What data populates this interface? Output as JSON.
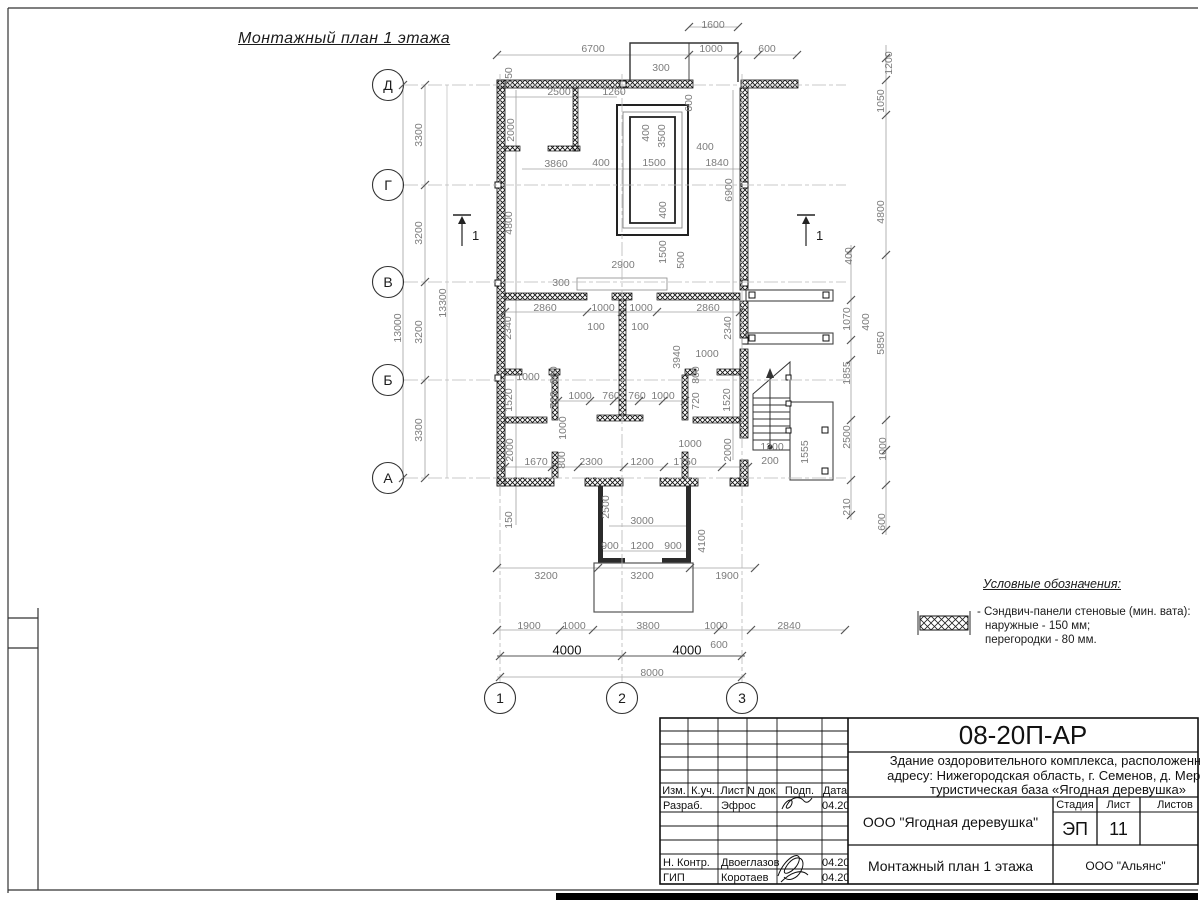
{
  "drawing_title": "Монтажный план 1 этажа",
  "colors": {
    "wall": "#111111",
    "dim_text": "#7c7c7c",
    "dim_line": "#a0a0a0",
    "axis_line": "#b8b8b8",
    "dark_text": "#111111"
  },
  "axes": {
    "rows": [
      {
        "label": "Д",
        "y": 85
      },
      {
        "label": "Г",
        "y": 185
      },
      {
        "label": "В",
        "y": 282
      },
      {
        "label": "Б",
        "y": 380
      },
      {
        "label": "А",
        "y": 478
      }
    ],
    "cols": [
      {
        "label": "1",
        "x": 500
      },
      {
        "label": "2",
        "x": 622
      },
      {
        "label": "3",
        "x": 742
      }
    ]
  },
  "section_marks": [
    {
      "label": "1",
      "x": 462,
      "y": 228
    },
    {
      "label": "1",
      "x": 806,
      "y": 228
    }
  ],
  "dimensions": [
    [
      "1600",
      713,
      25,
      0
    ],
    [
      "6700",
      593,
      49,
      0
    ],
    [
      "1000",
      711,
      49,
      0
    ],
    [
      "600",
      767,
      49,
      0
    ],
    [
      "300",
      661,
      68,
      0
    ],
    [
      "150",
      509,
      76,
      1
    ],
    [
      "2500",
      559,
      92,
      0
    ],
    [
      "1260",
      614,
      92,
      0
    ],
    [
      "600",
      689,
      103,
      1
    ],
    [
      "2000",
      511,
      130,
      1
    ],
    [
      "400",
      646,
      133,
      1
    ],
    [
      "3500",
      662,
      136,
      1
    ],
    [
      "3860",
      556,
      164,
      0
    ],
    [
      "400",
      601,
      163,
      0
    ],
    [
      "1500",
      654,
      163,
      0
    ],
    [
      "400",
      705,
      147,
      0
    ],
    [
      "1840",
      717,
      163,
      0
    ],
    [
      "6900",
      729,
      190,
      1
    ],
    [
      "4800",
      509,
      223,
      1
    ],
    [
      "400",
      663,
      210,
      1
    ],
    [
      "1500",
      663,
      252,
      1
    ],
    [
      "500",
      681,
      260,
      1
    ],
    [
      "2900",
      623,
      265,
      0
    ],
    [
      "300",
      561,
      283,
      0
    ],
    [
      "2860",
      545,
      308,
      0
    ],
    [
      "1000",
      603,
      308,
      0
    ],
    [
      "1000",
      641,
      308,
      0
    ],
    [
      "2860",
      708,
      308,
      0
    ],
    [
      "100",
      596,
      327,
      0
    ],
    [
      "100",
      640,
      327,
      0
    ],
    [
      "2340",
      508,
      328,
      1
    ],
    [
      "2340",
      728,
      328,
      1
    ],
    [
      "1000",
      528,
      377,
      0
    ],
    [
      "3940",
      677,
      357,
      1
    ],
    [
      "1000",
      707,
      354,
      0
    ],
    [
      "800",
      554,
      375,
      1
    ],
    [
      "720",
      554,
      400,
      1
    ],
    [
      "1520",
      509,
      400,
      1
    ],
    [
      "800",
      696,
      375,
      1
    ],
    [
      "720",
      696,
      401,
      1
    ],
    [
      "1520",
      727,
      400,
      1
    ],
    [
      "1000",
      580,
      396,
      0
    ],
    [
      "760",
      611,
      396,
      0
    ],
    [
      "760",
      637,
      396,
      0
    ],
    [
      "1000",
      663,
      396,
      0
    ],
    [
      "1000",
      563,
      428,
      1
    ],
    [
      "1000",
      690,
      444,
      0
    ],
    [
      "2000",
      510,
      450,
      1
    ],
    [
      "2000",
      728,
      450,
      1
    ],
    [
      "800",
      562,
      460,
      1
    ],
    [
      "1670",
      536,
      462,
      0
    ],
    [
      "2300",
      591,
      462,
      0
    ],
    [
      "1200",
      642,
      462,
      0
    ],
    [
      "1750",
      685,
      462,
      0
    ],
    [
      "1200",
      772,
      447,
      0
    ],
    [
      "200",
      770,
      461,
      0
    ],
    [
      "1555",
      805,
      452,
      1
    ],
    [
      "150",
      509,
      520,
      1
    ],
    [
      "2500",
      606,
      507,
      1
    ],
    [
      "3000",
      642,
      521,
      0
    ],
    [
      "900",
      610,
      546,
      0
    ],
    [
      "1200",
      642,
      546,
      0
    ],
    [
      "900",
      673,
      546,
      0
    ],
    [
      "4100",
      702,
      541,
      1
    ],
    [
      "3200",
      546,
      576,
      0
    ],
    [
      "3200",
      642,
      576,
      0
    ],
    [
      "1900",
      727,
      576,
      0
    ],
    [
      "1900",
      529,
      626,
      0
    ],
    [
      "1000",
      574,
      626,
      0
    ],
    [
      "3800",
      648,
      626,
      0
    ],
    [
      "1000",
      716,
      626,
      0
    ],
    [
      "2840",
      789,
      626,
      0
    ],
    [
      "4000",
      567,
      650,
      2
    ],
    [
      "4000",
      687,
      650,
      2
    ],
    [
      "600",
      719,
      645,
      0
    ],
    [
      "8000",
      652,
      673,
      0
    ],
    [
      "3300",
      419,
      135,
      1
    ],
    [
      "3200",
      419,
      233,
      1
    ],
    [
      "3200",
      419,
      332,
      1
    ],
    [
      "3300",
      419,
      430,
      1
    ],
    [
      "13000",
      398,
      328,
      1
    ],
    [
      "13300",
      443,
      303,
      1
    ],
    [
      "1200",
      889,
      63,
      1
    ],
    [
      "1050",
      881,
      101,
      1
    ],
    [
      "4800",
      881,
      212,
      1
    ],
    [
      "400",
      849,
      256,
      1
    ],
    [
      "1070",
      847,
      319,
      1
    ],
    [
      "400",
      866,
      322,
      1
    ],
    [
      "5850",
      881,
      343,
      1
    ],
    [
      "1855",
      847,
      373,
      1
    ],
    [
      "2500",
      847,
      437,
      1
    ],
    [
      "1000",
      883,
      449,
      1
    ],
    [
      "210",
      847,
      507,
      1
    ],
    [
      "600",
      882,
      522,
      1
    ]
  ],
  "ticks": [
    [
      425,
      85
    ],
    [
      425,
      185
    ],
    [
      425,
      282
    ],
    [
      425,
      380
    ],
    [
      425,
      478
    ],
    [
      403,
      85
    ],
    [
      403,
      478
    ],
    [
      497,
      55
    ],
    [
      689,
      55
    ],
    [
      738,
      55
    ],
    [
      758,
      55
    ],
    [
      797,
      55
    ],
    [
      689,
      27
    ],
    [
      738,
      27
    ],
    [
      497,
      568
    ],
    [
      598,
      568
    ],
    [
      690,
      568
    ],
    [
      755,
      568
    ],
    [
      497,
      630
    ],
    [
      560,
      630
    ],
    [
      593,
      630
    ],
    [
      718,
      630
    ],
    [
      751,
      630
    ],
    [
      845,
      630
    ],
    [
      500,
      656
    ],
    [
      622,
      656
    ],
    [
      742,
      656
    ],
    [
      500,
      677
    ],
    [
      742,
      677
    ],
    [
      886,
      58
    ],
    [
      886,
      80
    ],
    [
      886,
      115
    ],
    [
      886,
      255
    ],
    [
      886,
      420
    ],
    [
      886,
      450
    ],
    [
      886,
      485
    ],
    [
      886,
      530
    ],
    [
      851,
      250
    ],
    [
      851,
      300
    ],
    [
      851,
      340
    ],
    [
      851,
      360
    ],
    [
      851,
      420
    ],
    [
      851,
      480
    ],
    [
      851,
      515
    ],
    [
      505,
      312
    ],
    [
      587,
      312
    ],
    [
      622,
      312
    ],
    [
      657,
      312
    ],
    [
      740,
      312
    ],
    [
      558,
      401
    ],
    [
      590,
      401
    ],
    [
      614,
      401
    ],
    [
      639,
      401
    ],
    [
      663,
      401
    ],
    [
      685,
      401
    ],
    [
      505,
      467
    ],
    [
      552,
      467
    ],
    [
      578,
      467
    ],
    [
      624,
      467
    ],
    [
      664,
      467
    ],
    [
      722,
      467
    ],
    [
      748,
      467
    ]
  ],
  "legend": {
    "heading": "Условные обозначения:",
    "item_line1": "- Сэндвич-панели стеновые (мин. вата):",
    "item_line2": "наружные - 150 мм;",
    "item_line3": "перегородки - 80 мм."
  },
  "title_block": {
    "code": "08-20П-АР",
    "desc_line1": "Здание оздоровительного комплекса, расположенное п",
    "desc_line2": "адресу: Нижегородская область, г. Семенов, д. Меринов",
    "desc_line3": "туристическая база «Ягодная деревушка»",
    "cols": {
      "izm": "Изм.",
      "kuch": "К.уч.",
      "list": "Лист",
      "ndok": "N док.",
      "podp": "Подп.",
      "data": "Дата"
    },
    "rows": [
      {
        "role": "Разраб.",
        "name": "Эфрос",
        "date": "04.20"
      },
      {
        "role": "Н. Контр.",
        "name": "Двоеглазов",
        "date": "04.20"
      },
      {
        "role": "ГИП",
        "name": "Коротаев",
        "date": "04.20"
      }
    ],
    "org": "ООО \"Ягодная деревушка\"",
    "stage_label": "Стадия",
    "sheet_label": "Лист",
    "sheets_label": "Листов",
    "stage": "ЭП",
    "sheet": "11",
    "doc_name": "Монтажный план 1 этажа",
    "contractor": "ООО \"Альянс\""
  }
}
